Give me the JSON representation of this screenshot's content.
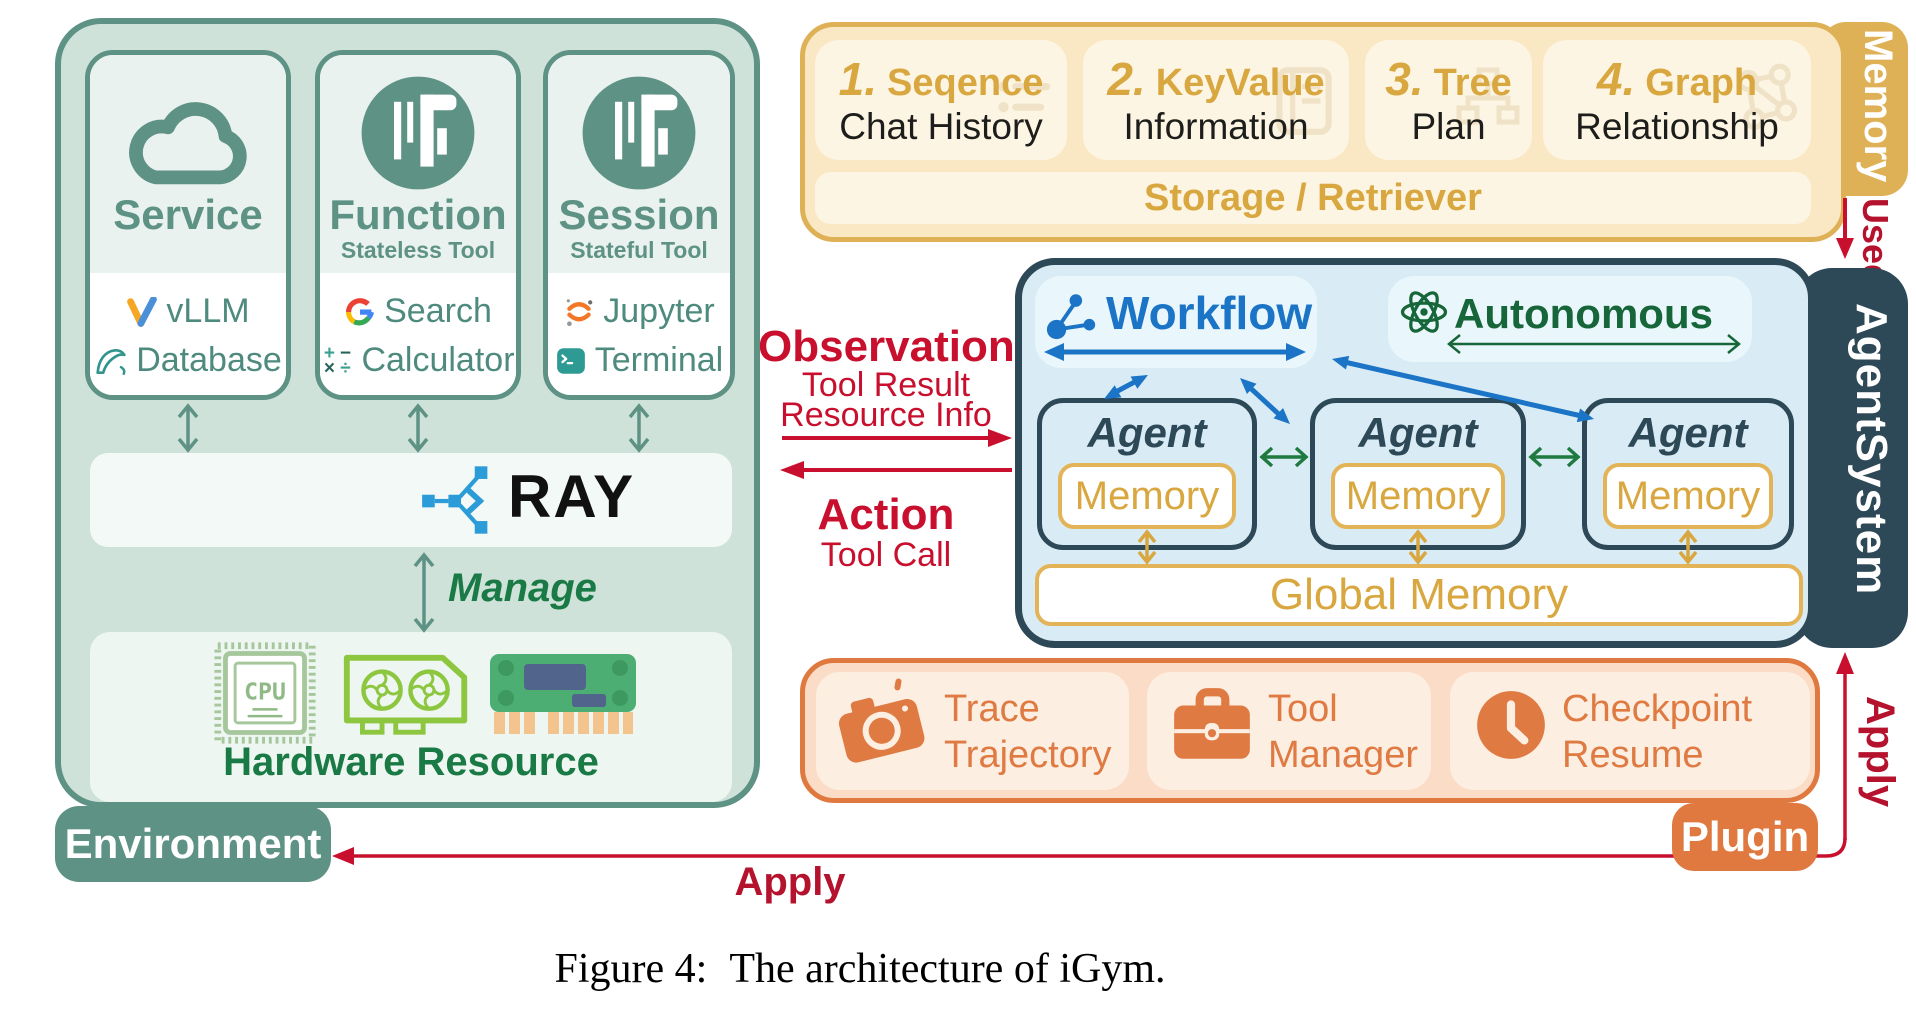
{
  "colors": {
    "teal": "#5E9284",
    "env_bg": "#CFE2DA",
    "card_header": "#E9F2EE",
    "teal_text": "#4E8A7D",
    "ray_blue": "#2B9CD8",
    "green_text": "#1A7A46",
    "gold_border": "#DFB156",
    "gold_text": "#D9A73F",
    "memory_bg": "#FAE8C5",
    "memory_card_bg": "#FDF5E3",
    "red": "#C8102E",
    "dark_red_label": "#B5122E",
    "navy": "#2D4856",
    "agent_bg": "#D9ECF5",
    "chip_bg": "#E9F6FB",
    "blue": "#1B74C5",
    "dark_green": "#17663A",
    "green_arrow": "#1F7A3F",
    "orange": "#E0793F",
    "plugin_bg": "#FBDCC6",
    "plugin_card_bg": "#FDEEE2",
    "plugin_text": "#DE7A42"
  },
  "environment": {
    "tab_label": "Environment",
    "cards": [
      {
        "title": "Service",
        "subtitle": "",
        "icon": "cloud-icon",
        "items": [
          {
            "icon": "vllm-icon",
            "label": "vLLM"
          },
          {
            "icon": "mysql-dolphin-icon",
            "label": "Database"
          }
        ]
      },
      {
        "title": "Function",
        "subtitle": "Stateless Tool",
        "icon": "caliper-tool-icon",
        "items": [
          {
            "icon": "google-g-icon",
            "label": "Search"
          },
          {
            "icon": "calculator-icon",
            "label": "Calculator"
          }
        ]
      },
      {
        "title": "Session",
        "subtitle": "Stateful Tool",
        "icon": "caliper-tool-icon",
        "items": [
          {
            "icon": "jupyter-icon",
            "label": "Jupyter"
          },
          {
            "icon": "terminal-icon",
            "label": "Terminal"
          }
        ]
      }
    ],
    "calculator_glyphs": {
      "plus": "+",
      "minus": "−",
      "times": "×",
      "divide": "÷"
    },
    "ray_label": "RAY",
    "manage_label": "Manage",
    "hardware_label": "Hardware Resource",
    "hardware_icons": [
      "cpu-icon",
      "gpu-icon",
      "ram-icon"
    ]
  },
  "memory": {
    "tab_label": "Memory",
    "cards": [
      {
        "number": "1.",
        "title": "Seqence",
        "subtitle": "Chat History",
        "watermark_icon": "chat-list-icon"
      },
      {
        "number": "2.",
        "title": "KeyValue",
        "subtitle": "Information",
        "watermark_icon": "dictionary-icon"
      },
      {
        "number": "3.",
        "title": "Tree",
        "subtitle": "Plan",
        "watermark_icon": "sitemap-icon"
      },
      {
        "number": "4.",
        "title": "Graph",
        "subtitle": "Relationship",
        "watermark_icon": "graph-network-icon"
      }
    ],
    "storage_label": "Storage / Retriever"
  },
  "agent_system": {
    "tab_label": "AgentSystem",
    "workflow_label": "Workflow",
    "autonomous_label": "Autonomous",
    "agents": [
      {
        "title": "Agent",
        "memory_label": "Memory"
      },
      {
        "title": "Agent",
        "memory_label": "Memory"
      },
      {
        "title": "Agent",
        "memory_label": "Memory"
      }
    ],
    "global_memory_label": "Global Memory"
  },
  "plugin": {
    "tab_label": "Plugin",
    "items": [
      {
        "icon": "camera-icon",
        "line1": "Trace",
        "line2": "Trajectory"
      },
      {
        "icon": "briefcase-icon",
        "line1": "Tool",
        "line2": "Manager"
      },
      {
        "icon": "clock-icon",
        "line1": "Checkpoint",
        "line2": "Resume"
      }
    ]
  },
  "flows": {
    "observation": {
      "title": "Observation",
      "sub1": "Tool Result",
      "sub2": "Resource Info"
    },
    "action": {
      "title": "Action",
      "sub": "Tool Call"
    },
    "used_label": "Used",
    "apply_right_label": "Apply",
    "apply_bottom_label": "Apply"
  },
  "caption": {
    "prefix": "Figure 4:",
    "text": "The architecture of iGym."
  }
}
